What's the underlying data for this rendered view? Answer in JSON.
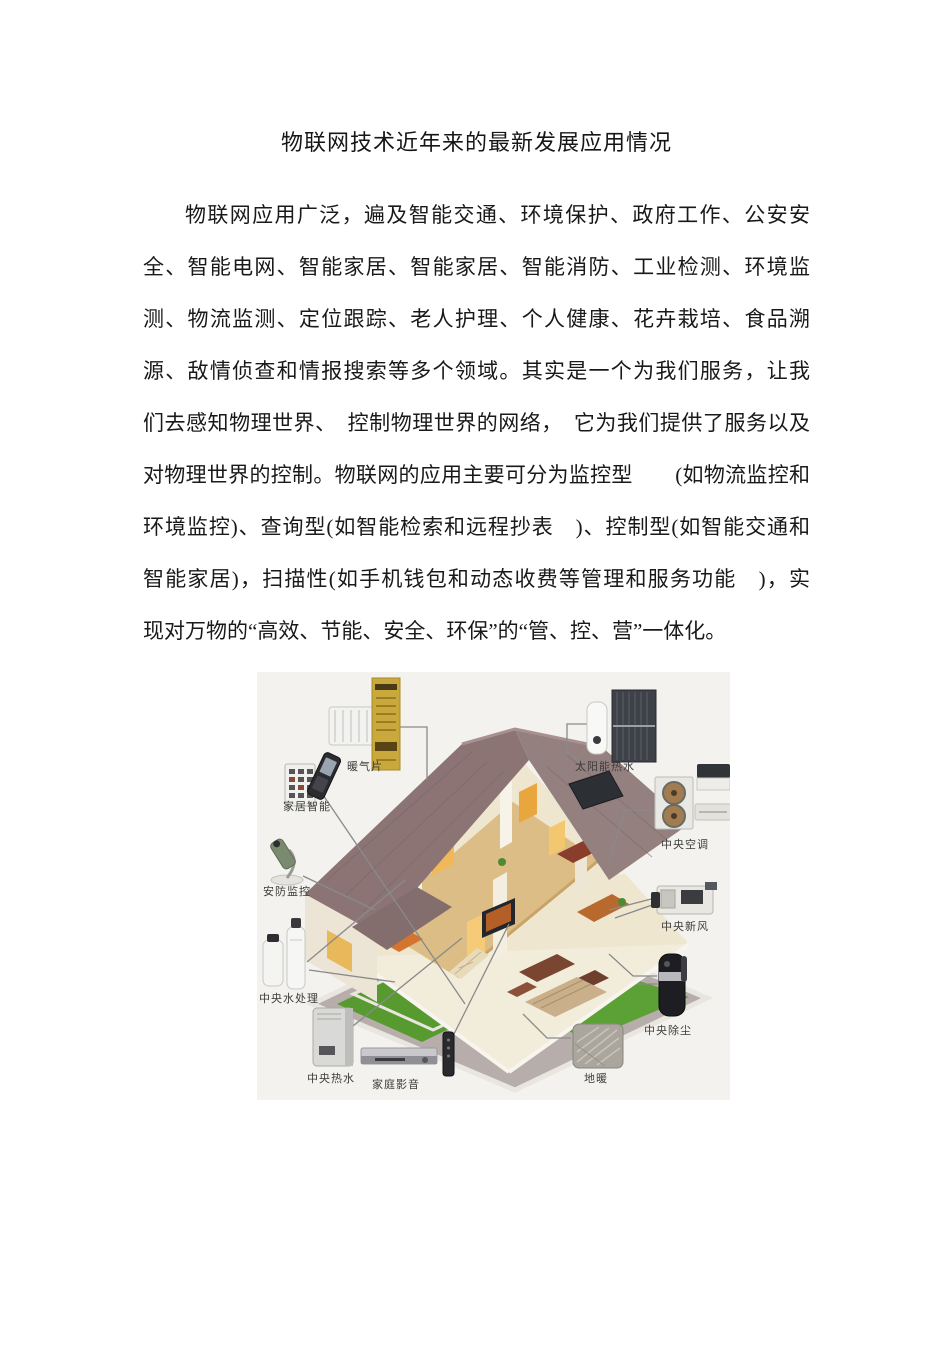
{
  "document": {
    "title": "物联网技术近年来的最新发展应用情况",
    "paragraph_lines": [
      "物联网应用广泛，遍及智能交通、环境保护、政府工作、公安安",
      "全、智能电网、智能家居、智能家居、智能消防、工业检测、环境监",
      "测、物流监测、定位跟踪、老人护理、个人健康、花卉栽培、食品溯",
      "源、敌情侦查和情报搜索等多个领域。其实是一个为我们服务，让我",
      "们去感知物理世界、　控制物理世界的网络，　它为我们提供了服务以及",
      "对物理世界的控制。物联网的应用主要可分为监控型　　(如物流监控和",
      "环境监控)、查询型(如智能检索和远程抄表　)、控制型(如智能交通和",
      "智能家居)，扫描性(如手机钱包和动态收费等管理和服务功能　)，实",
      "现对万物的“高效、节能、安全、环保”的“管、控、营”一体化。"
    ]
  },
  "figure": {
    "description_devices": [
      {
        "id": "radiator",
        "label": "暖气片"
      },
      {
        "id": "solar-water-heater",
        "label": "太阳能热水"
      },
      {
        "id": "home-automation",
        "label": "家居智能"
      },
      {
        "id": "central-ac",
        "label": "中央空调"
      },
      {
        "id": "security-camera",
        "label": "安防监控"
      },
      {
        "id": "fresh-air",
        "label": "中央新风"
      },
      {
        "id": "water-treatment",
        "label": "中央水处理"
      },
      {
        "id": "central-vacuum",
        "label": "中央除尘"
      },
      {
        "id": "hot-water",
        "label": "中央热水"
      },
      {
        "id": "home-av",
        "label": "家庭影音"
      },
      {
        "id": "floor-heating",
        "label": "地暖"
      }
    ],
    "colors": {
      "figure_background": "#f3f2ef",
      "roof": "#8c7474",
      "wall": "#efe6d0",
      "lawn": "#579a30",
      "path": "#b7aeab",
      "accent_panel_yellow": "#c9a93c",
      "leader_line": "#8a8a8a"
    }
  }
}
